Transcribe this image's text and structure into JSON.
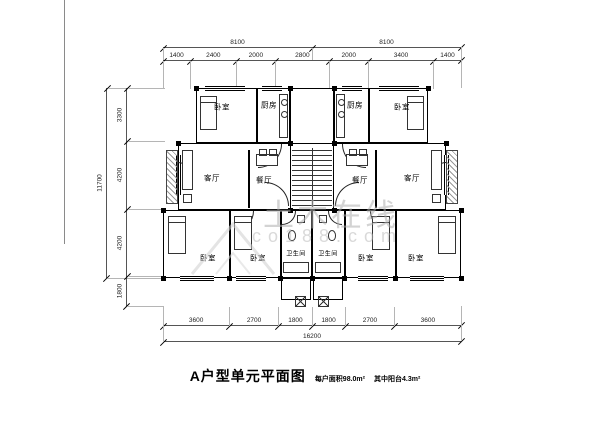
{
  "title": {
    "main": "A户型单元平面图",
    "area_note": "每户面积98.0m²",
    "balcony_note": "其中阳台4.3m²"
  },
  "watermark": {
    "name": "土木在线",
    "domain": "co188.com"
  },
  "rooms": {
    "bedroom": "卧室",
    "kitchen": "厨房",
    "living": "客厅",
    "dining": "餐厅",
    "bathroom": "卫生间"
  },
  "dimensions": {
    "top_totals": [
      "8100",
      "8100"
    ],
    "top_segments": [
      "1400",
      "2400",
      "2000",
      "2800",
      "2000",
      "3400",
      "1400"
    ],
    "left_total": "11700",
    "left_segments": [
      "3300",
      "4200",
      "4200",
      "1800"
    ],
    "bottom_segments": [
      "3600",
      "2700",
      "1800",
      "1800",
      "2700",
      "3600"
    ],
    "bottom_total": "16200"
  }
}
